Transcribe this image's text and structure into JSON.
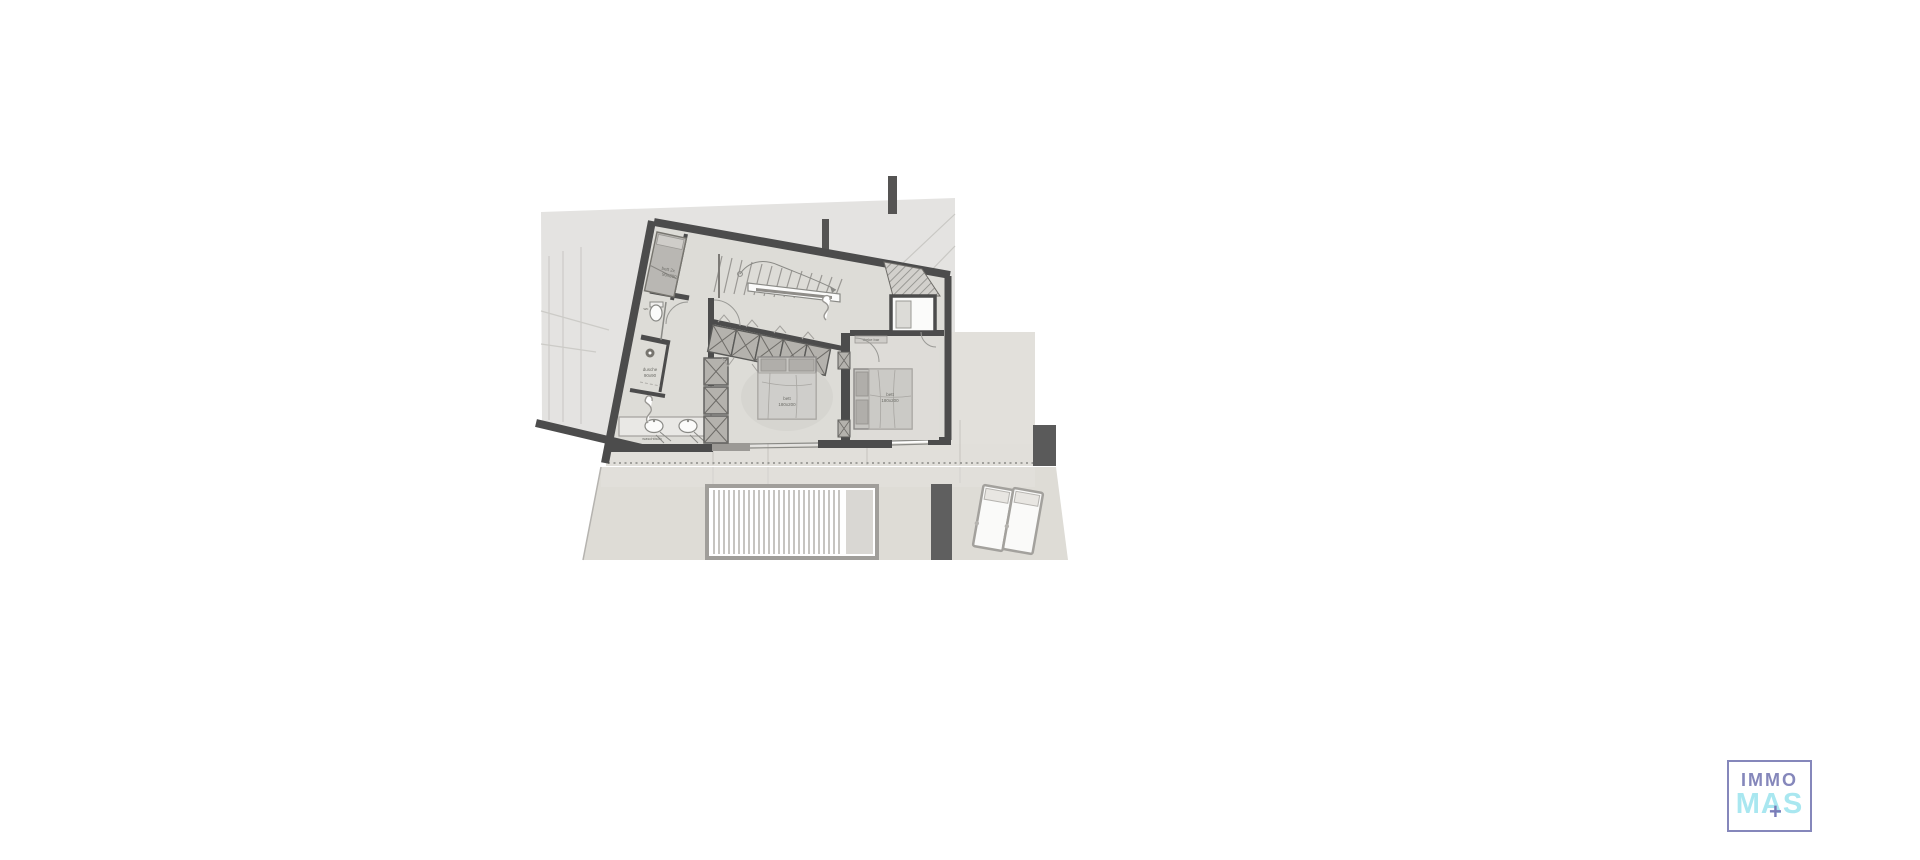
{
  "page": {
    "background": "#ffffff",
    "description": "architectural floor plan drawing, upper floor of a villa with terrace"
  },
  "plan": {
    "colors": {
      "site_gray": "#e4e3e1",
      "floor": "#dddcd7",
      "wall_dark": "#4c4c4c",
      "closet_fill": "#b4b2ad",
      "terrace": "#e0deda",
      "deck": "#dedcd6",
      "rug": "#d6d5d0",
      "planter_bar": "#5f5f5f"
    },
    "labels": {
      "bunk_bed_l1": "bett 2x",
      "bunk_bed_l2": "90x200",
      "wc": "wc",
      "shower_l1": "dusche",
      "shower_l2": "90x90",
      "vanity": "waschtisch",
      "master_bed_l1": "bett",
      "master_bed_l2": "180x200",
      "guest_bed_l1": "bett",
      "guest_bed_l2": "180x200",
      "bar": "theke bar"
    }
  },
  "logo": {
    "line1": "IMMO",
    "line2": "MAS",
    "plus": "+",
    "border_color": "#8587bb",
    "line1_color": "#8587bb",
    "line2_color": "#a9e7f0",
    "plus_color": "#7a7cb8"
  }
}
